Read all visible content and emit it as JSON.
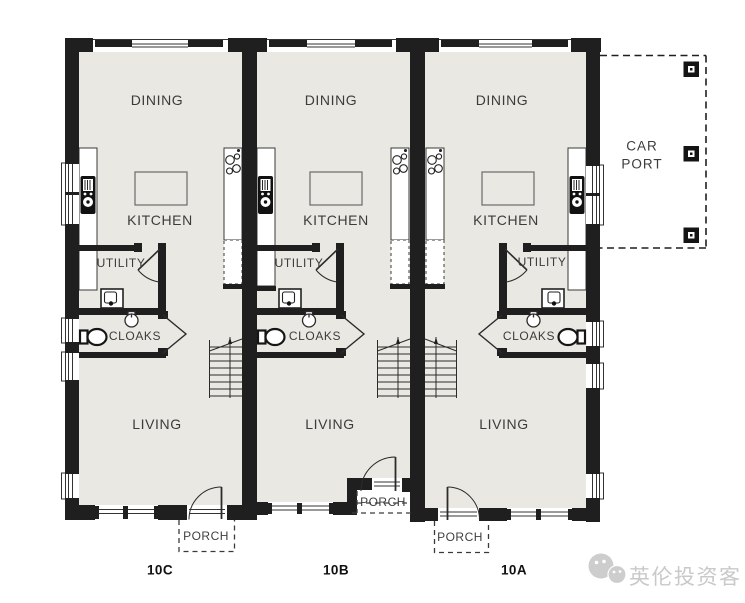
{
  "plan": {
    "rooms": {
      "dining": "DINING",
      "kitchen": "KITCHEN",
      "utility": "UTILITY",
      "cloaks": "CLOAKS",
      "living": "LIVING",
      "porch": "PORCH",
      "carport": "CAR PORT"
    },
    "units": [
      {
        "label": "10C"
      },
      {
        "label": "10B"
      },
      {
        "label": "10A"
      }
    ],
    "colors": {
      "floor": "#e9e8e3",
      "wall": "#1f1f1f",
      "label_text": "#3c3c3c",
      "counter_fill": "#ffffff",
      "dashed_line": "#2a2a2a"
    }
  },
  "watermark": {
    "text": "英伦投资客",
    "color": "#c9c9c9"
  }
}
